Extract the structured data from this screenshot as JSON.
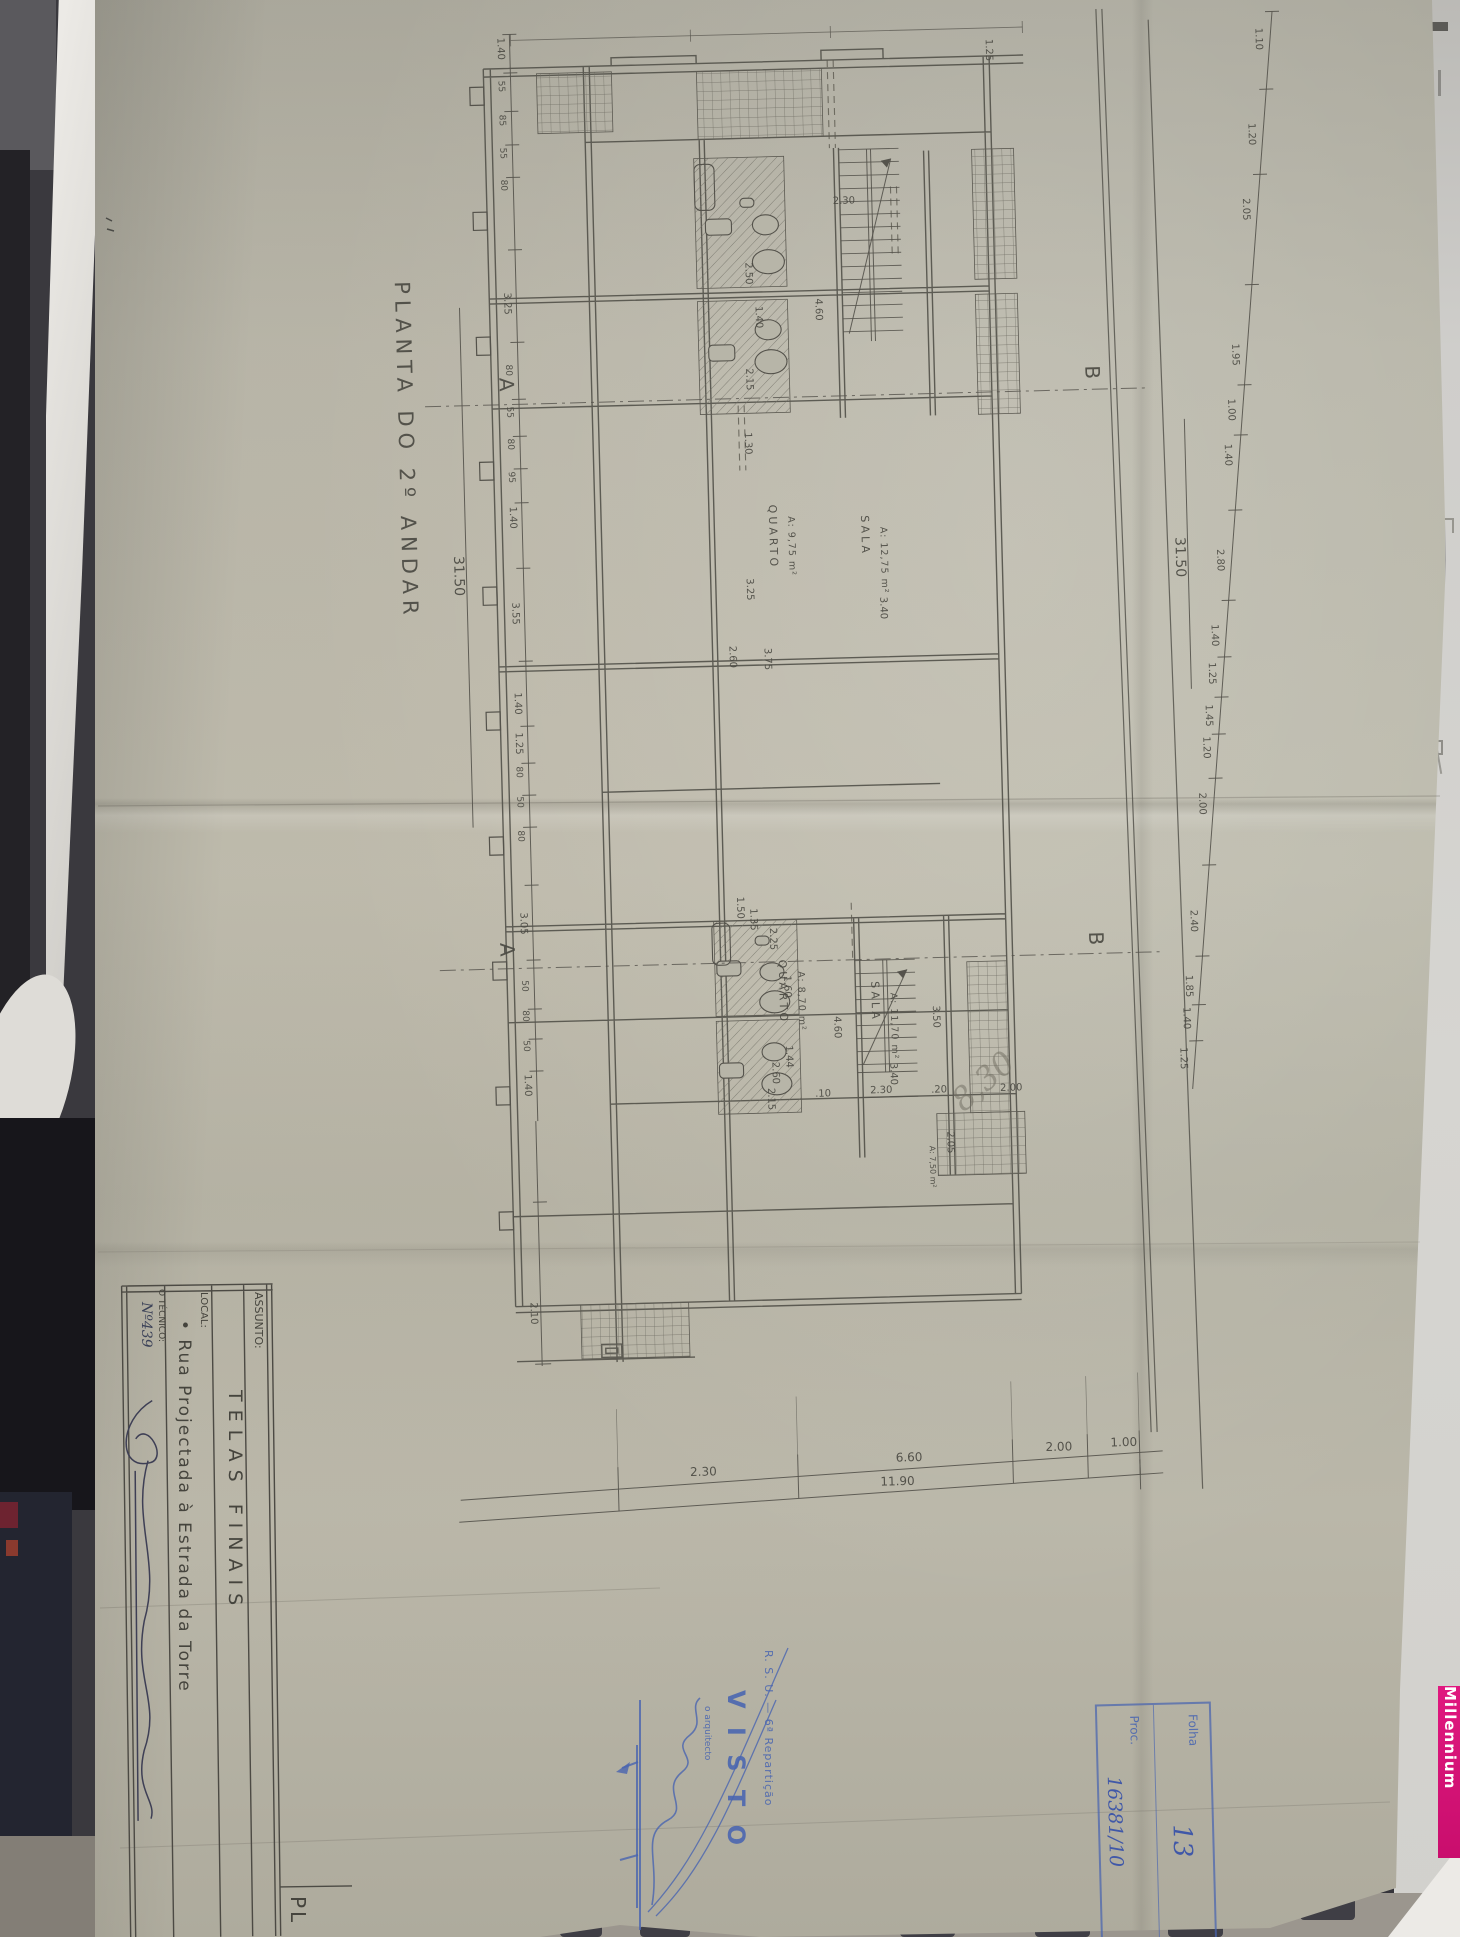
{
  "photo": {
    "millennium": "Millennium"
  },
  "title_block": {
    "assunto_label": "ASSUNTO:",
    "assunto_value": "TELAS  FINAIS",
    "local_label": "LOCAL:",
    "local_value": "• Rua  Projectada  à  Estrada  da  Torre",
    "tecnico_label": "O TÉCNICO:",
    "tecnico_number": "Nº439",
    "adjacent_cell": "PL"
  },
  "stamps": {
    "visto_line1": "R. S. U. — 6ª Repartição",
    "visto_word": "V I S T O",
    "visto_sub": "o arquitecto",
    "folha_label": "Folha",
    "folha_value": "13",
    "proc_label": "Proc.",
    "proc_value": "16381/10"
  },
  "drawing": {
    "title": "PLANTA  DO  2º  ANDAR",
    "section_a": "A",
    "section_b": "B",
    "balcony_area": "A: 7,50 m²",
    "pencil_note": "8,30",
    "rooms": [
      {
        "name": "QUARTO",
        "area": "A: 9,75 m²",
        "x": 766,
        "y": 505
      },
      {
        "name": "SALA",
        "area": "A: 12,75 m²",
        "x": 858,
        "y": 518
      },
      {
        "name": "QUARTO",
        "area": "A: 8,70 m²",
        "x": 764,
        "y": 960
      },
      {
        "name": "SALA",
        "area": "A: 11,70 m²",
        "x": 856,
        "y": 984
      }
    ],
    "dims": [
      {
        "t": "1.30",
        "x": 744,
        "y": 432
      },
      {
        "t": "3.25",
        "x": 742,
        "y": 578
      },
      {
        "t": "2.60",
        "x": 723,
        "y": 645
      },
      {
        "t": "3.75",
        "x": 758,
        "y": 648
      },
      {
        "t": "3.40",
        "x": 875,
        "y": 600
      },
      {
        "t": "2.30",
        "x": 838,
        "y": 206,
        "h": 1
      },
      {
        "t": "4.60",
        "x": 818,
        "y": 300
      },
      {
        "t": "2.50",
        "x": 749,
        "y": 262
      },
      {
        "t": "1.40",
        "x": 758,
        "y": 306
      },
      {
        "t": "2.15",
        "x": 747,
        "y": 368
      },
      {
        "t": "2.25",
        "x": 756,
        "y": 928
      },
      {
        "t": "1.60",
        "x": 769,
        "y": 976
      },
      {
        "t": "1.44",
        "x": 769,
        "y": 1046
      },
      {
        "t": "2.15",
        "x": 750,
        "y": 1088
      },
      {
        "t": "1.35",
        "x": 737,
        "y": 908
      },
      {
        "t": "1.50",
        "x": 724,
        "y": 896
      },
      {
        "t": "4.60",
        "x": 818,
        "y": 1018
      },
      {
        "t": "2.60",
        "x": 755,
        "y": 1062
      },
      {
        "t": "3.40",
        "x": 873,
        "y": 1066
      },
      {
        "t": "3.50",
        "x": 917,
        "y": 1010
      },
      {
        "t": "2.30",
        "x": 852,
        "y": 1096,
        "h": 1
      },
      {
        "t": ".10",
        "x": 797,
        "y": 1098,
        "h": 1
      },
      {
        "t": ".20",
        "x": 913,
        "y": 1097,
        "h": 1
      },
      {
        "t": "2.00",
        "x": 982,
        "y": 1097,
        "h": 1
      },
      {
        "t": "2.05",
        "x": 928,
        "y": 1136
      },
      {
        "t": "1.25",
        "x": 995,
        "y": 45
      }
    ],
    "left_chain": {
      "total": "31.50",
      "values": [
        {
          "t": "1.40",
          "y": 45
        },
        {
          "t": "55",
          "y": 88
        },
        {
          "t": "85",
          "y": 122
        },
        {
          "t": "55",
          "y": 155
        },
        {
          "t": "80",
          "y": 187
        },
        {
          "t": "3.25",
          "y": 300
        },
        {
          "t": "80",
          "y": 372
        },
        {
          "t": "55",
          "y": 414
        },
        {
          "t": "80",
          "y": 446
        },
        {
          "t": "95",
          "y": 479
        },
        {
          "t": "1.40",
          "y": 514
        },
        {
          "t": "3.55",
          "y": 610
        },
        {
          "t": "1.40",
          "y": 700
        },
        {
          "t": "1.25",
          "y": 740
        },
        {
          "t": "80",
          "y": 774
        },
        {
          "t": "50",
          "y": 804
        },
        {
          "t": "80",
          "y": 838
        },
        {
          "t": "3.05",
          "y": 920
        },
        {
          "t": "50",
          "y": 988
        },
        {
          "t": "80",
          "y": 1018
        },
        {
          "t": "50",
          "y": 1048
        },
        {
          "t": "1.40",
          "y": 1082
        },
        {
          "t": "2.10",
          "y": 1310
        }
      ]
    },
    "right_chain": {
      "total": "31.50",
      "values": [
        {
          "t": "1.10",
          "y": 55
        },
        {
          "t": "1.20",
          "y": 150
        },
        {
          "t": "2.05",
          "y": 225
        },
        {
          "t": "1.95",
          "y": 370
        },
        {
          "t": "1.00",
          "y": 425
        },
        {
          "t": "1.40",
          "y": 470
        },
        {
          "t": "2.80",
          "y": 575
        },
        {
          "t": "1.40",
          "y": 650
        },
        {
          "t": "1.25",
          "y": 688
        },
        {
          "t": "1.45",
          "y": 730
        },
        {
          "t": "1.20",
          "y": 762
        },
        {
          "t": "2.00",
          "y": 818
        },
        {
          "t": "2.40",
          "y": 935
        },
        {
          "t": "1.85",
          "y": 1000
        },
        {
          "t": "1.40",
          "y": 1032
        },
        {
          "t": "1.25",
          "y": 1072
        }
      ]
    },
    "bottom_chain": {
      "labels": [
        {
          "t": "2.30",
          "x": 662
        },
        {
          "t": "6.60",
          "x": 868
        },
        {
          "t": "2.00",
          "x": 1018
        },
        {
          "t": "1.00",
          "x": 1083
        }
      ],
      "total": "11.90",
      "total_x": 852
    }
  }
}
